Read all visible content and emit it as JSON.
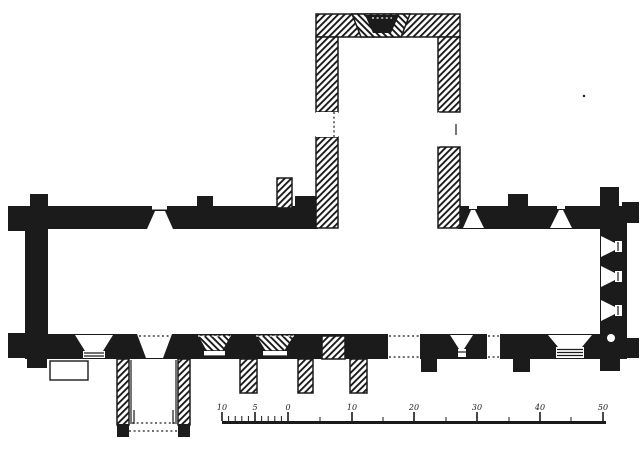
{
  "colors": {
    "ink": "#1b1b1b",
    "paper": "#ffffff"
  },
  "scale_bar": {
    "labels": [
      "10",
      "5",
      "0",
      "10",
      "20",
      "30",
      "40",
      "50"
    ],
    "label_positions": [
      222,
      255,
      288,
      352,
      414,
      477,
      540,
      603
    ],
    "minor_ticks": [
      228.6,
      235.2,
      241.8,
      248.4,
      261.6,
      268.2,
      274.8,
      281.4
    ],
    "mid_ticks": [
      320,
      383,
      446,
      509,
      571
    ],
    "baseline": {
      "x1": 222,
      "x2": 606,
      "y": 421,
      "thickness": 3
    },
    "label_y": 410,
    "tick_heights": {
      "label": 9,
      "minor": 5,
      "mid": 4
    }
  },
  "plan": {
    "shapes": [
      {
        "n": "nw-buttress-west",
        "t": "rect",
        "f": "solid",
        "x": 8,
        "y": 206,
        "w": 19,
        "h": 25
      },
      {
        "n": "sw-buttress-west",
        "t": "rect",
        "f": "solid",
        "x": 8,
        "y": 333,
        "w": 19,
        "h": 25
      },
      {
        "n": "nw-buttress-north",
        "t": "rect",
        "f": "solid",
        "x": 30,
        "y": 194,
        "w": 18,
        "h": 14
      },
      {
        "n": "nave-north-buttress",
        "t": "rect",
        "f": "solid",
        "x": 197,
        "y": 196,
        "w": 16,
        "h": 12
      },
      {
        "n": "chancel-north-buttress",
        "t": "rect",
        "f": "solid",
        "x": 508,
        "y": 194,
        "w": 20,
        "h": 14
      },
      {
        "n": "ne-buttress-north",
        "t": "rect",
        "f": "solid",
        "x": 600,
        "y": 187,
        "w": 19,
        "h": 21
      },
      {
        "n": "ne-buttress-east",
        "t": "rect",
        "f": "solid",
        "x": 622,
        "y": 202,
        "w": 17,
        "h": 21
      },
      {
        "n": "se-buttress-east",
        "t": "rect",
        "f": "solid",
        "x": 622,
        "y": 338,
        "w": 17,
        "h": 20
      },
      {
        "n": "sw-buttress-south",
        "t": "rect",
        "f": "solid",
        "x": 27,
        "y": 357,
        "w": 20,
        "h": 11
      },
      {
        "n": "se-buttress-south",
        "t": "rect",
        "f": "solid",
        "x": 600,
        "y": 357,
        "w": 20,
        "h": 14
      },
      {
        "n": "chancel-south-buttress-1",
        "t": "rect",
        "f": "solid",
        "x": 421,
        "y": 357,
        "w": 16,
        "h": 15
      },
      {
        "n": "chancel-south-buttress-2",
        "t": "rect",
        "f": "solid",
        "x": 513,
        "y": 357,
        "w": 17,
        "h": 15
      },
      {
        "n": "west-wall",
        "t": "rect",
        "f": "solid",
        "x": 25,
        "y": 206,
        "w": 23,
        "h": 153
      },
      {
        "n": "east-wall",
        "t": "rect",
        "f": "solid",
        "x": 600,
        "y": 206,
        "w": 27,
        "h": 153
      },
      {
        "n": "nave-north-wall",
        "t": "rect",
        "f": "solid",
        "x": 25,
        "y": 206,
        "w": 293,
        "h": 23
      },
      {
        "n": "nave-transept-junction-mass",
        "t": "rect",
        "f": "solid",
        "x": 295,
        "y": 196,
        "w": 23,
        "h": 33
      },
      {
        "n": "chancel-north-wall",
        "t": "rect",
        "f": "solid",
        "x": 458,
        "y": 206,
        "w": 169,
        "h": 23
      },
      {
        "n": "south-wall",
        "t": "rect",
        "f": "solid",
        "x": 25,
        "y": 334,
        "w": 602,
        "h": 25
      },
      {
        "n": "south-buttress-hatched-1",
        "t": "rect",
        "f": "hatch",
        "x": 240,
        "y": 359,
        "w": 17,
        "h": 34
      },
      {
        "n": "south-buttress-hatched-2",
        "t": "rect",
        "f": "hatch",
        "x": 298,
        "y": 359,
        "w": 15,
        "h": 34
      },
      {
        "n": "south-buttress-hatched-3",
        "t": "rect",
        "f": "hatch",
        "x": 350,
        "y": 359,
        "w": 17,
        "h": 34
      },
      {
        "n": "transept-north-wall",
        "t": "rect",
        "f": "hatch",
        "x": 316,
        "y": 14,
        "w": 144,
        "h": 23
      },
      {
        "n": "transept-west-wall-upper",
        "t": "rect",
        "f": "hatch",
        "x": 316,
        "y": 37,
        "w": 22,
        "h": 75
      },
      {
        "n": "transept-west-wall-lower",
        "t": "rect",
        "f": "hatch",
        "x": 316,
        "y": 137,
        "w": 22,
        "h": 91
      },
      {
        "n": "transept-east-wall-upper",
        "t": "rect",
        "f": "hatch",
        "x": 438,
        "y": 37,
        "w": 22,
        "h": 75
      },
      {
        "n": "transept-east-wall-lower",
        "t": "rect",
        "f": "hatch",
        "x": 438,
        "y": 147,
        "w": 22,
        "h": 81
      },
      {
        "n": "stair-pier",
        "t": "rect",
        "f": "hatch",
        "x": 277,
        "y": 178,
        "w": 15,
        "h": 30
      },
      {
        "n": "wall-pier-hatched",
        "t": "rect",
        "f": "hatch",
        "x": 322,
        "y": 336,
        "w": 23,
        "h": 23
      },
      {
        "n": "porch-west-wall",
        "t": "rect",
        "f": "hatch",
        "x": 117,
        "y": 359,
        "w": 12,
        "h": 66
      },
      {
        "n": "porch-east-wall",
        "t": "rect",
        "f": "hatch",
        "x": 178,
        "y": 359,
        "w": 12,
        "h": 66
      },
      {
        "n": "porch-west-foot",
        "t": "rect",
        "f": "solid",
        "x": 117,
        "y": 424,
        "w": 12,
        "h": 13
      },
      {
        "n": "porch-east-foot",
        "t": "rect",
        "f": "solid",
        "x": 178,
        "y": 424,
        "w": 12,
        "h": 13
      },
      {
        "n": "transept-north-window-splay",
        "t": "poly",
        "f": "hatchRev",
        "p": "352,14 410,14 401,37 361,37"
      },
      {
        "n": "transept-north-window-core",
        "t": "poly",
        "f": "solid",
        "p": "365,15 399,15 391,33 373,33"
      },
      {
        "n": "transept-north-window-dots",
        "t": "line",
        "f": "paperline",
        "d": true,
        "x1": 372,
        "y1": 18,
        "x2": 392,
        "y2": 18
      },
      {
        "n": "transept-west-window",
        "t": "rect",
        "f": "white",
        "x": 316,
        "y": 112,
        "w": 22,
        "h": 25
      },
      {
        "n": "transept-west-window-inner-line",
        "t": "line",
        "d": true,
        "x1": 334,
        "y1": 112,
        "x2": 334,
        "y2": 137
      },
      {
        "n": "transept-east-window",
        "t": "poly",
        "f": "white",
        "p": "438,112 456,121 456,138 438,147"
      },
      {
        "n": "transept-east-window-slit",
        "t": "rect",
        "f": "white",
        "x": 453,
        "y": 123,
        "w": 6,
        "h": 13
      },
      {
        "n": "transept-east-window-slit-line",
        "t": "line",
        "x1": 456,
        "y1": 124,
        "x2": 456,
        "y2": 135
      },
      {
        "n": "nave-north-window",
        "t": "poly",
        "f": "white",
        "p": "147,229 173,229 165,211 155,211"
      },
      {
        "n": "nave-north-window-slit",
        "t": "rect",
        "f": "white",
        "x": 152,
        "y": 206,
        "w": 15,
        "h": 4
      },
      {
        "n": "nave-north-window-lintel",
        "t": "rect",
        "f": "solid",
        "x": 152,
        "y": 209.5,
        "w": 15,
        "h": 1.5
      },
      {
        "n": "chancel-north-window-1",
        "t": "poly",
        "f": "white",
        "p": "463,228 484,228 475,210 471,210"
      },
      {
        "n": "chancel-north-window-1-slit",
        "t": "rect",
        "f": "white",
        "x": 469,
        "y": 206,
        "w": 8,
        "h": 3
      },
      {
        "n": "chancel-north-window-2",
        "t": "poly",
        "f": "white",
        "p": "550,228 572,228 563,210 559,210"
      },
      {
        "n": "chancel-north-window-2-slit",
        "t": "rect",
        "f": "white",
        "x": 557,
        "y": 206,
        "w": 8,
        "h": 3
      },
      {
        "n": "nave-southwest-window",
        "t": "poly",
        "f": "white",
        "p": "75,335 113,335 103,351 85,351"
      },
      {
        "n": "nave-southwest-window-sill",
        "t": "rect",
        "f": "white",
        "x": 83,
        "y": 351,
        "w": 22,
        "h": 7
      },
      {
        "n": "nave-southwest-window-sill-line-1",
        "t": "line",
        "x1": 84,
        "y1": 353,
        "x2": 104,
        "y2": 353
      },
      {
        "n": "nave-southwest-window-sill-line-2",
        "t": "line",
        "x1": 84,
        "y1": 356,
        "x2": 104,
        "y2": 356
      },
      {
        "n": "porch-doorway",
        "t": "poly",
        "f": "white",
        "p": "137,334 172,334 163,358 146,358"
      },
      {
        "n": "porch-doorway-dots",
        "t": "line",
        "d": true,
        "x1": 139,
        "y1": 336,
        "x2": 170,
        "y2": 336
      },
      {
        "n": "nave-south-window-1",
        "t": "poly",
        "f": "hatchRev",
        "p": "197,335 232,335 223,351 206,351"
      },
      {
        "n": "nave-south-window-1-gap",
        "t": "rect",
        "f": "white",
        "x": 204,
        "y": 351,
        "w": 21,
        "h": 5
      },
      {
        "n": "nave-south-window-1-line",
        "t": "line",
        "x1": 204,
        "y1": 356,
        "x2": 225,
        "y2": 356
      },
      {
        "n": "nave-south-window-1-dots",
        "t": "line",
        "f": "paperline",
        "d": true,
        "x1": 198,
        "y1": 336,
        "x2": 231,
        "y2": 336
      },
      {
        "n": "nave-south-window-2",
        "t": "poly",
        "f": "hatchRev",
        "p": "255,335 295,335 285,351 265,351"
      },
      {
        "n": "nave-south-window-2-gap",
        "t": "rect",
        "f": "white",
        "x": 263,
        "y": 351,
        "w": 24,
        "h": 5
      },
      {
        "n": "nave-south-window-2-line",
        "t": "line",
        "x1": 263,
        "y1": 356,
        "x2": 287,
        "y2": 356
      },
      {
        "n": "nave-south-window-2-dots",
        "t": "line",
        "f": "paperline",
        "d": true,
        "x1": 256,
        "y1": 336,
        "x2": 294,
        "y2": 336
      },
      {
        "n": "south-doorway",
        "t": "rect",
        "f": "white",
        "x": 388,
        "y": 334,
        "w": 32,
        "h": 25
      },
      {
        "n": "south-doorway-dots-top",
        "t": "line",
        "d": true,
        "x1": 389,
        "y1": 336,
        "x2": 419,
        "y2": 336
      },
      {
        "n": "south-doorway-dots-bottom",
        "t": "line",
        "d": true,
        "x1": 389,
        "y1": 357,
        "x2": 419,
        "y2": 357
      },
      {
        "n": "chancel-south-window",
        "t": "poly",
        "f": "white",
        "p": "450,335 473,335 464,349 459,349"
      },
      {
        "n": "chancel-south-window-slit",
        "t": "rect",
        "f": "white",
        "x": 458,
        "y": 349,
        "w": 8,
        "h": 8
      },
      {
        "n": "chancel-south-window-line",
        "t": "line",
        "x1": 458,
        "y1": 352,
        "x2": 466,
        "y2": 352
      },
      {
        "n": "priest-doorway",
        "t": "rect",
        "f": "white",
        "x": 487,
        "y": 334,
        "w": 13,
        "h": 25
      },
      {
        "n": "priest-doorway-dots-top",
        "t": "line",
        "d": true,
        "x1": 488,
        "y1": 336,
        "x2": 499,
        "y2": 336
      },
      {
        "n": "priest-doorway-dots-bottom",
        "t": "line",
        "d": true,
        "x1": 488,
        "y1": 357,
        "x2": 499,
        "y2": 357
      },
      {
        "n": "chancel-low-window",
        "t": "poly",
        "f": "white",
        "p": "548,335 592,335 582,347 558,347"
      },
      {
        "n": "chancel-low-window-sill",
        "t": "rect",
        "f": "white",
        "x": 556,
        "y": 347,
        "w": 28,
        "h": 11
      },
      {
        "n": "chancel-low-window-sill-line-1",
        "t": "line",
        "x1": 557,
        "y1": 349.5,
        "x2": 583,
        "y2": 349.5
      },
      {
        "n": "chancel-low-window-sill-line-2",
        "t": "line",
        "x1": 557,
        "y1": 352.5,
        "x2": 583,
        "y2": 352.5
      },
      {
        "n": "chancel-low-window-sill-line-3",
        "t": "line",
        "x1": 557,
        "y1": 355.5,
        "x2": 583,
        "y2": 355.5
      },
      {
        "n": "east-window-1",
        "t": "poly",
        "f": "white",
        "p": "601,236 615,243 615,250 601,257"
      },
      {
        "n": "east-window-1-slit",
        "t": "rect",
        "f": "white",
        "x": 615,
        "y": 241,
        "w": 7,
        "h": 11
      },
      {
        "n": "east-window-1-slit-line",
        "t": "line",
        "x1": 618,
        "y1": 242,
        "x2": 618,
        "y2": 251
      },
      {
        "n": "east-window-2",
        "t": "poly",
        "f": "white",
        "p": "601,266 615,273 615,280 601,287"
      },
      {
        "n": "east-window-2-slit",
        "t": "rect",
        "f": "white",
        "x": 615,
        "y": 271,
        "w": 7,
        "h": 11
      },
      {
        "n": "east-window-2-slit-line",
        "t": "line",
        "x1": 618,
        "y1": 272,
        "x2": 618,
        "y2": 281
      },
      {
        "n": "east-window-3",
        "t": "poly",
        "f": "white",
        "p": "601,300 615,307 615,314 601,321"
      },
      {
        "n": "east-window-3-slit",
        "t": "rect",
        "f": "white",
        "x": 615,
        "y": 305,
        "w": 7,
        "h": 11
      },
      {
        "n": "east-window-3-slit-line",
        "t": "line",
        "x1": 618,
        "y1": 306,
        "x2": 618,
        "y2": 315
      },
      {
        "n": "piscina-circle",
        "t": "circle",
        "f": "white",
        "cx": 611,
        "cy": 338,
        "r": 4
      },
      {
        "n": "plinth-outline",
        "t": "rect",
        "f": "white",
        "s": true,
        "x": 50,
        "y": 361,
        "w": 38,
        "h": 19
      },
      {
        "n": "porch-inner-line-west",
        "t": "line",
        "x1": 131,
        "y1": 360,
        "x2": 131,
        "y2": 424
      },
      {
        "n": "porch-inner-line-east",
        "t": "line",
        "x1": 176,
        "y1": 360,
        "x2": 176,
        "y2": 424
      },
      {
        "n": "porch-jamb-line-west",
        "t": "line",
        "x1": 134,
        "y1": 410,
        "x2": 134,
        "y2": 424
      },
      {
        "n": "porch-jamb-line-east",
        "t": "line",
        "x1": 173,
        "y1": 410,
        "x2": 173,
        "y2": 424
      },
      {
        "n": "porch-inner-dots",
        "t": "line",
        "d": true,
        "x1": 132,
        "y1": 423,
        "x2": 175,
        "y2": 423
      },
      {
        "n": "porch-threshold-dots",
        "t": "line",
        "d": true,
        "x1": 129,
        "y1": 431,
        "x2": 178,
        "y2": 431
      },
      {
        "n": "paper-speck",
        "t": "circle",
        "f": "solid",
        "cx": 584,
        "cy": 96,
        "r": 1.2
      }
    ]
  }
}
